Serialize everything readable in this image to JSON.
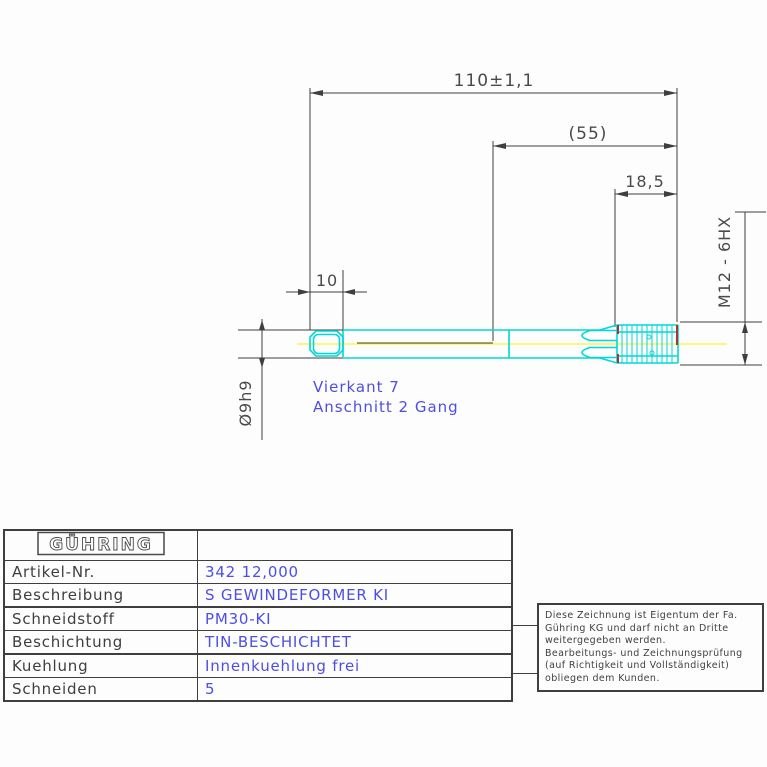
{
  "drawing": {
    "dims": {
      "overall_length": "110±1,1",
      "half_length": "(55)",
      "thread_length": "18,5",
      "square_length": "10",
      "shank_diameter": "Ø9h9",
      "thread_spec": "M12 - 6HX"
    },
    "annotations": {
      "square_note": "Vierkant 7",
      "lead_note": "Anschnitt 2 Gang"
    },
    "colors": {
      "line": "#3f3f3f",
      "tool_outline": "#00d8d8",
      "centerline": "#ffff00",
      "chamfer_mark": "#b23030",
      "annotation_blue": "#4e4ee6"
    }
  },
  "table": {
    "logo": "GÜHRING",
    "rows": [
      {
        "label": "Artikel-Nr.",
        "value": "342 12,000"
      },
      {
        "label": "Beschreibung",
        "value": "S GEWINDEFORMER KI"
      },
      {
        "label": "Schneidstoff",
        "value": "PM30-KI"
      },
      {
        "label": "Beschichtung",
        "value": "TIN-BESCHICHTET"
      },
      {
        "label": "Kuehlung",
        "value": "Innenkuehlung frei"
      },
      {
        "label": "Schneiden",
        "value": "5"
      }
    ]
  },
  "disclaimer": {
    "lines": [
      "Diese Zeichnung ist Eigentum der Fa.",
      "Gühring KG und darf nicht an Dritte",
      "weitergegeben werden.",
      "Bearbeitungs- und Zeichnungsprüfung",
      "(auf Richtigkeit und Vollständigkeit)",
      "obliegen dem Kunden."
    ]
  }
}
